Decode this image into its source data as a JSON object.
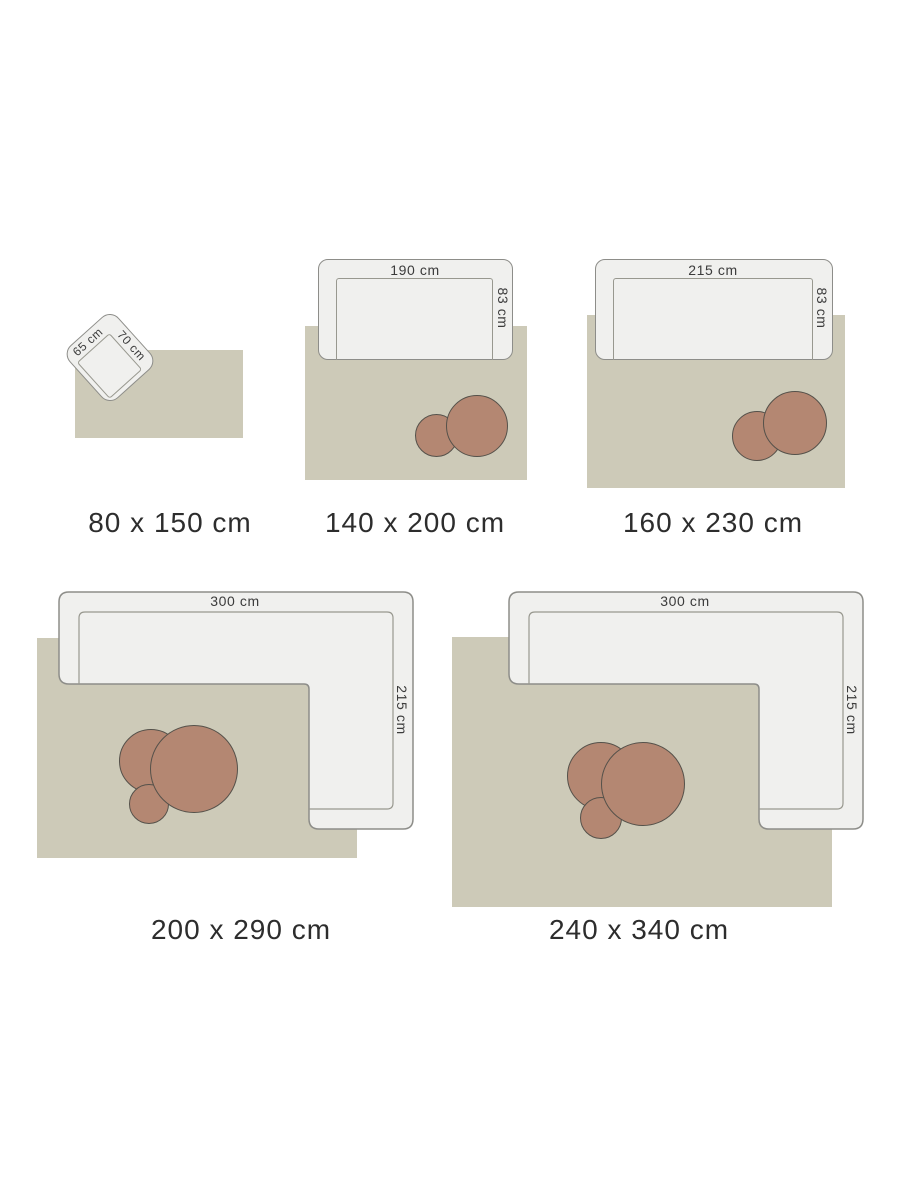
{
  "colors": {
    "background": "#ffffff",
    "rug": "#cdcab8",
    "furniture_fill": "#f0f0ee",
    "furniture_border": "#8d8d89",
    "seat_line": "#98988f",
    "table_fill": "#b48772",
    "table_border": "#55514a",
    "caption_text": "#2d2d2d",
    "dimension_text": "#3b3b3b"
  },
  "items": [
    {
      "caption": "80 x 150 cm",
      "furniture": "armchair",
      "width_label": "65 cm",
      "depth_label": "70 cm"
    },
    {
      "caption": "140 x 200 cm",
      "furniture": "sofa",
      "width_label": "190 cm",
      "depth_label": "83 cm"
    },
    {
      "caption": "160 x 230 cm",
      "furniture": "sofa",
      "width_label": "215 cm",
      "depth_label": "83 cm"
    },
    {
      "caption": "200 x 290 cm",
      "furniture": "corner-sofa",
      "width_label": "300 cm",
      "depth_label": "215 cm"
    },
    {
      "caption": "240 x 340 cm",
      "furniture": "corner-sofa",
      "width_label": "300 cm",
      "depth_label": "215 cm"
    }
  ]
}
